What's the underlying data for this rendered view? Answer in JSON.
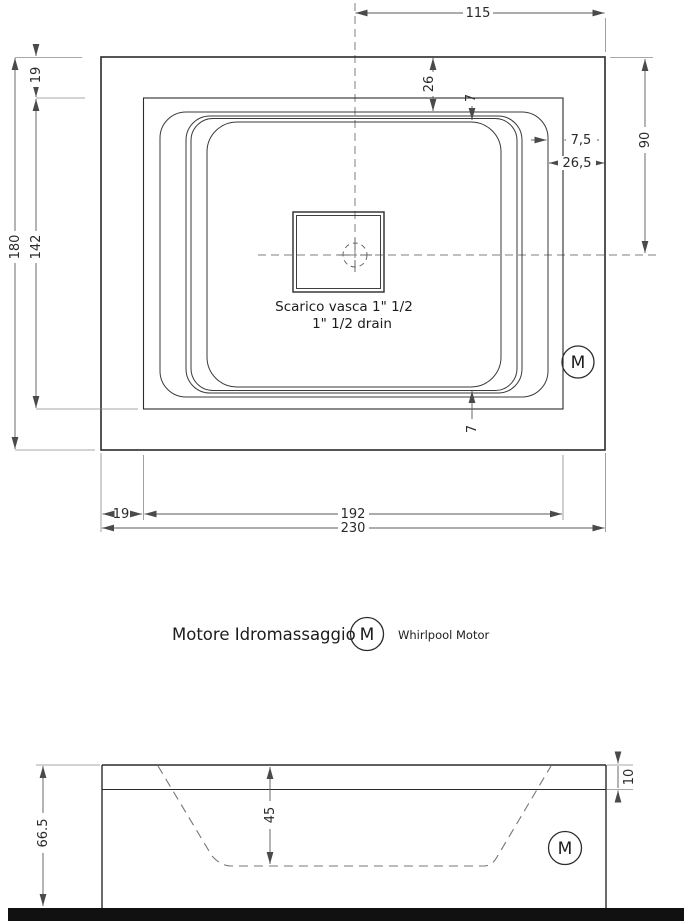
{
  "drawing_title": "Whirlpool bathtub technical drawing",
  "plan_view": {
    "dims": {
      "half_width_top": "115",
      "rim_inset_top": "26",
      "rim_edge_top": "7",
      "rim_edge_bottom": "7",
      "lip_width_right": "7,5",
      "side_border_right": "26,5",
      "half_height_right": "90",
      "overall_height_left": "180",
      "inner_height_left": "142",
      "border_top_left": "19",
      "border_bottom_left": "19",
      "inner_width_bottom": "192",
      "overall_width_bottom": "230"
    },
    "drain": {
      "label_it": "Scarico vasca 1\" 1/2",
      "label_en": "1\" 1/2  drain"
    },
    "motor_symbol": "M"
  },
  "legend": {
    "label_it": "Motore Idromassaggio",
    "symbol": "M",
    "label_en": "Whirlpool Motor"
  },
  "side_view": {
    "overall_height": "66.5",
    "inner_depth": "45",
    "rim_height": "10",
    "motor_symbol": "M"
  },
  "colors": {
    "line": "#2b2b2b",
    "dimension": "#5a5a5a",
    "floor": "#111111",
    "background": "#ffffff"
  }
}
